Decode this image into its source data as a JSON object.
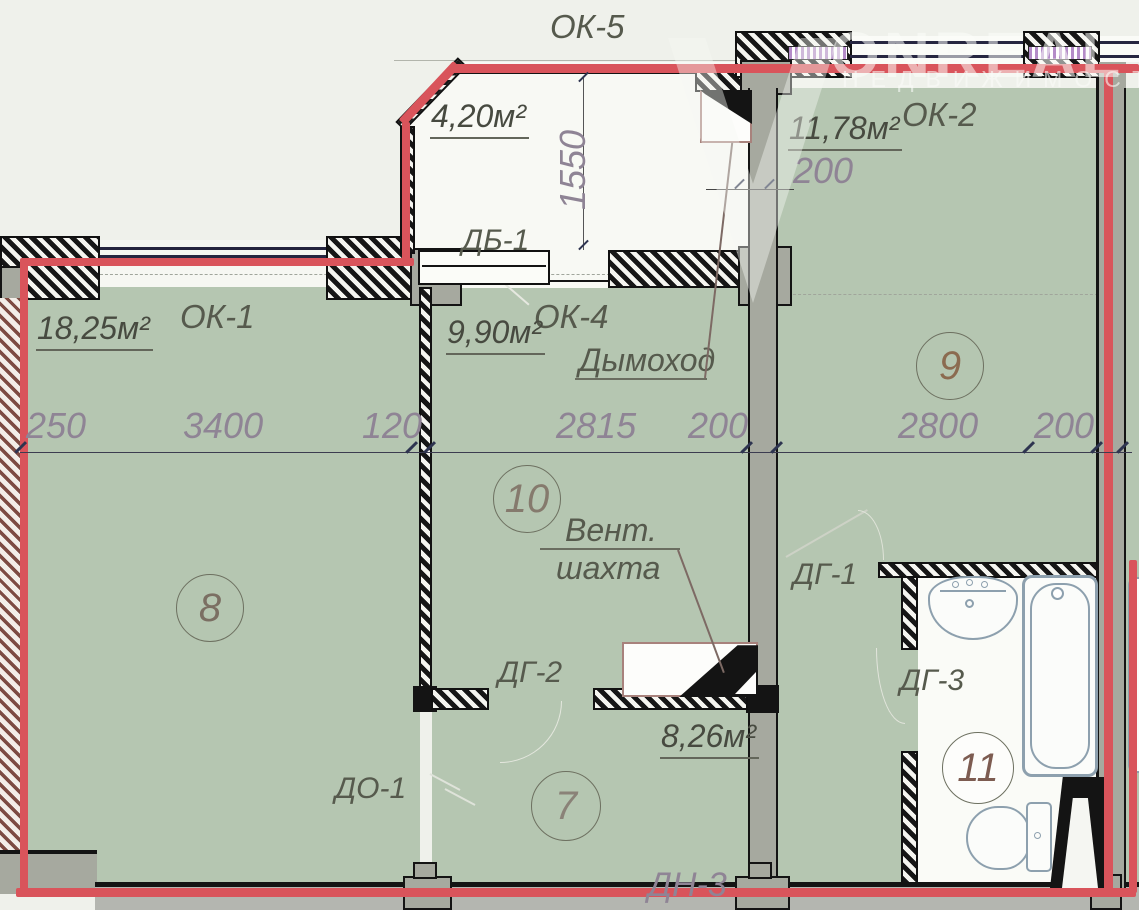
{
  "watermark": {
    "brand": "ONREAL",
    "subtitle": "НЕДВИЖИМОСТ"
  },
  "rooms": {
    "room8": {
      "number": "8",
      "area": "18,25м²"
    },
    "room9": {
      "number": "9",
      "area": "11,78м²",
      "wall_dim": "200"
    },
    "room10": {
      "number": "10",
      "area": "9,90м²"
    },
    "room7": {
      "number": "7",
      "area": "8,26м²"
    },
    "room11": {
      "number": "11"
    },
    "balcony": {
      "area": "4,20м²",
      "width_dim": "1550"
    }
  },
  "windows": {
    "ok1": "ОК-1",
    "ok2": "ОК-2",
    "ok4": "ОК-4",
    "ok5": "ОК-5"
  },
  "doors": {
    "db1": "ДБ-1",
    "dg1": "ДГ-1",
    "dg2": "ДГ-2",
    "dg3": "ДГ-3",
    "do1": "ДО-1",
    "dn3": "ДН-3"
  },
  "annotations": {
    "chimney": "Дымоход",
    "vent_line1": "Вент.",
    "vent_line2": "шахта"
  },
  "dimensions": {
    "bottom_row": [
      "250",
      "3400",
      "120",
      "2815",
      "200",
      "2800",
      "200"
    ]
  },
  "colors": {
    "room_fill": "#b5c6b1",
    "background": "#eff1eb",
    "outline_red": "#d9545b",
    "wall_grey": "#a6a99f",
    "wall_black": "#141414",
    "brick_hatch": "#7d4b42",
    "dim_text": "#8f8495",
    "label_text": "#565a4d",
    "area_text": "#474a40",
    "fixture_stroke": "#8da0ae",
    "insulation_purple": "#b48cc8"
  }
}
